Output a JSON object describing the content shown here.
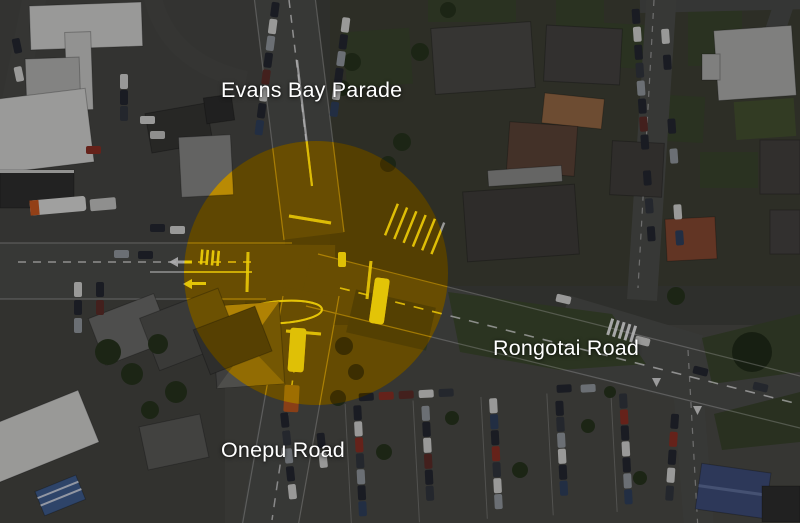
{
  "map": {
    "type": "satellite-aerial-photo",
    "description": "Darkened aerial photograph of a road intersection highlighted with a yellow circle",
    "road_labels": [
      {
        "id": "evans-bay-parade",
        "text": "Evans Bay Parade"
      },
      {
        "id": "rongotai-road",
        "text": "Rongotai Road"
      },
      {
        "id": "onepu-road",
        "text": "Onepu Road"
      }
    ],
    "highlight": {
      "shape": "circle",
      "color_hex": "#ffd400"
    },
    "label_text_color_hex": "#ffffff"
  }
}
